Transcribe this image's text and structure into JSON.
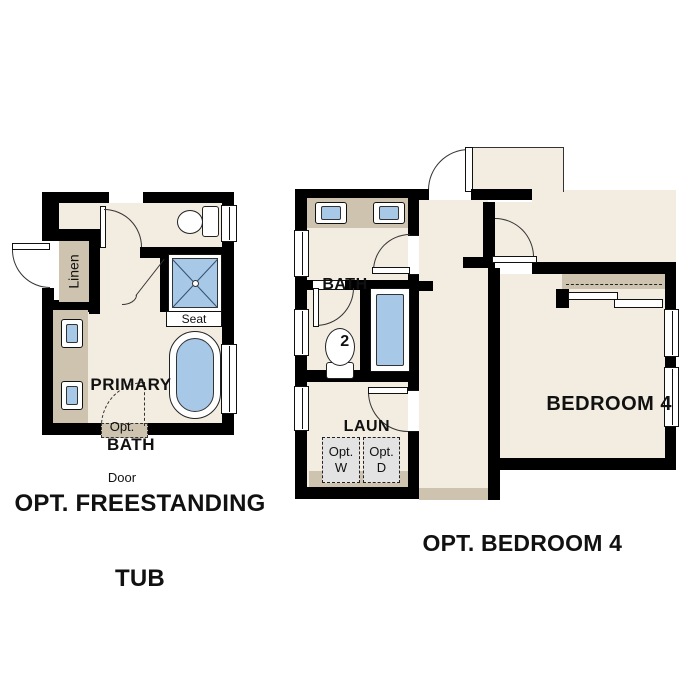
{
  "colors": {
    "floor": "#f2ece1",
    "counter_tan": "#cdc3ae",
    "fixture_blue": "#a8c8e8",
    "appliance_gray": "#e3e3e3",
    "wall": "#000000",
    "line": "#333333",
    "text": "#111111"
  },
  "left_plan": {
    "caption_line1": "OPT. FREESTANDING",
    "caption_line2": "TUB",
    "room_label_line1": "PRIMARY",
    "room_label_line2": "BATH",
    "linen_label": "Linen",
    "seat_label": "Seat",
    "opt_door_line1": "Opt.",
    "opt_door_line2": "Door"
  },
  "right_plan": {
    "caption": "OPT. BEDROOM 4",
    "bath_label_line1": "BATH",
    "bath_label_line2": "2",
    "laundry_label": "LAUN",
    "bedroom_label": "BEDROOM 4",
    "opt_washer_line1": "Opt.",
    "opt_washer_line2": "W",
    "opt_dryer_line1": "Opt.",
    "opt_dryer_line2": "D"
  }
}
